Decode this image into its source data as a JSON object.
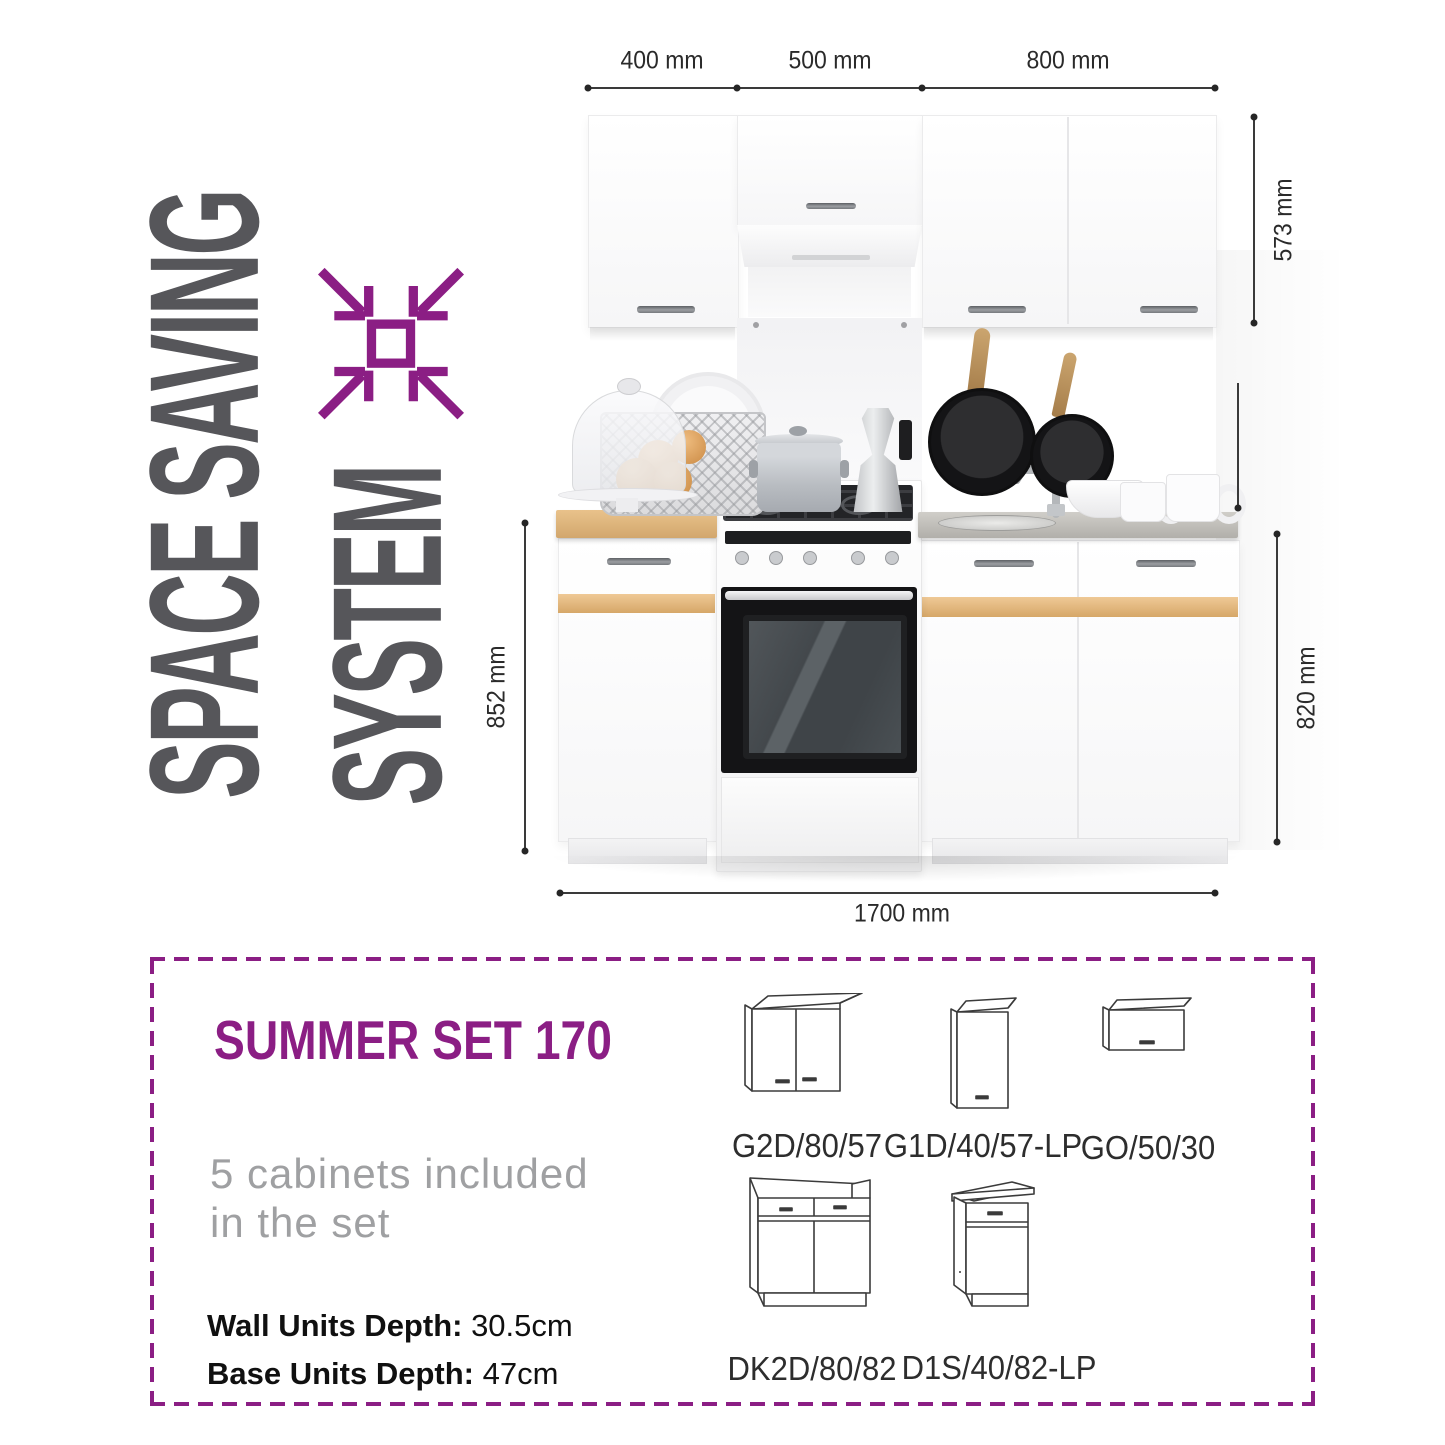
{
  "hero": {
    "line1": "SPACE SAVING",
    "line2": "SYSTEM"
  },
  "dims": {
    "top": [
      "400 mm",
      "500 mm",
      "800 mm"
    ],
    "wall_height": "573 mm",
    "base_left": "852 mm",
    "base_right": "820 mm",
    "total_width": "1700 mm"
  },
  "panel": {
    "title": "SUMMER SET 170",
    "subtitle_line1": "5 cabinets included",
    "subtitle_line2": "in the set",
    "specs": [
      {
        "label": "Wall Units Depth:",
        "value": " 30.5cm"
      },
      {
        "label": "Base Units Depth:",
        "value": " 47cm"
      }
    ],
    "cabinets": [
      "G2D/80/57",
      "G1D/40/57-LP",
      "GO/50/30",
      "DK2D/80/82",
      "D1S/40/82-LP"
    ]
  },
  "icons": {
    "space_saving": "compress-arrows-icon"
  },
  "colors": {
    "purple": "#8b1e84",
    "heading_gray": "#56565a",
    "dim_color": "#2a2a2a",
    "oak": "#dcae72"
  }
}
